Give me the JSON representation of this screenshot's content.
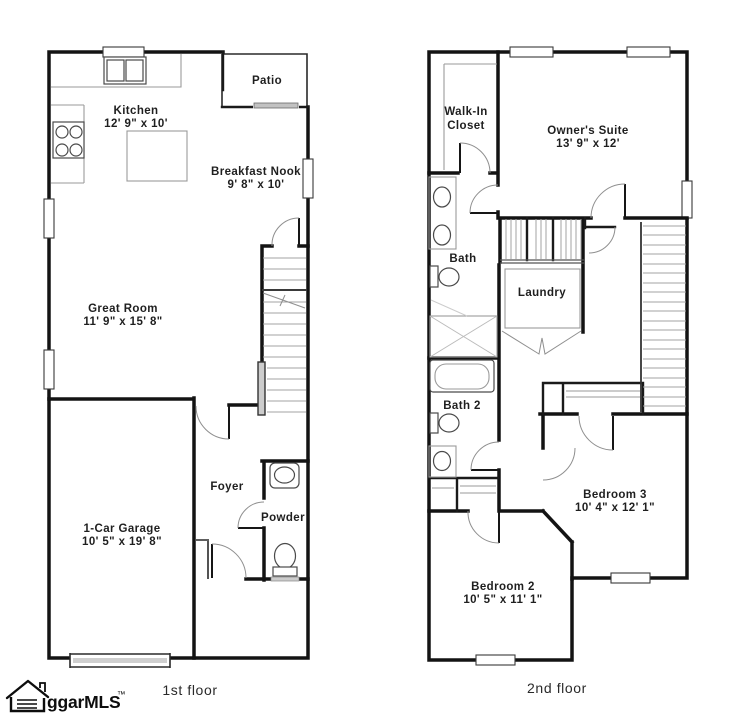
{
  "document": {
    "type": "residential floor plan"
  },
  "colors": {
    "wall": "#131313",
    "light_lines": "#9a9a9a",
    "text": "#1f1f1f",
    "background": "#ffffff"
  },
  "floor1": {
    "caption": "1st floor",
    "rooms": {
      "patio": {
        "name": "Patio"
      },
      "kitchen": {
        "name": "Kitchen",
        "dims": "12' 9\" x 10'"
      },
      "breakfast_nook": {
        "name": "Breakfast Nook",
        "dims": "9' 8\" x 10'"
      },
      "great_room": {
        "name": "Great Room",
        "dims": "11' 9\" x 15' 8\""
      },
      "garage": {
        "name": "1-Car Garage",
        "dims": "10' 5\" x 19' 8\""
      },
      "foyer": {
        "name": "Foyer"
      },
      "powder": {
        "name": "Powder"
      }
    }
  },
  "floor2": {
    "caption": "2nd floor",
    "rooms": {
      "walk_in_closet": {
        "line1": "Walk-In",
        "line2": "Closet"
      },
      "owners_suite": {
        "name": "Owner's Suite",
        "dims": "13' 9\" x 12'"
      },
      "bath": {
        "name": "Bath"
      },
      "laundry": {
        "name": "Laundry"
      },
      "bath2": {
        "name": "Bath 2"
      },
      "bedroom3": {
        "name": "Bedroom 3",
        "dims": "10' 4\" x 12' 1\""
      },
      "bedroom2": {
        "name": "Bedroom 2",
        "dims": "10' 5\" x 11' 1\""
      }
    }
  },
  "logo": {
    "text": "ggarMLS",
    "trademark": "™"
  },
  "icons": {
    "logo_house": "house-outline",
    "fixtures": [
      "stove",
      "kitchen-sink",
      "kitchen-island",
      "pedestal-sink",
      "toilet",
      "vanity-sinks",
      "shower",
      "bathtub",
      "staircase",
      "garage-door",
      "sliding-door"
    ]
  }
}
